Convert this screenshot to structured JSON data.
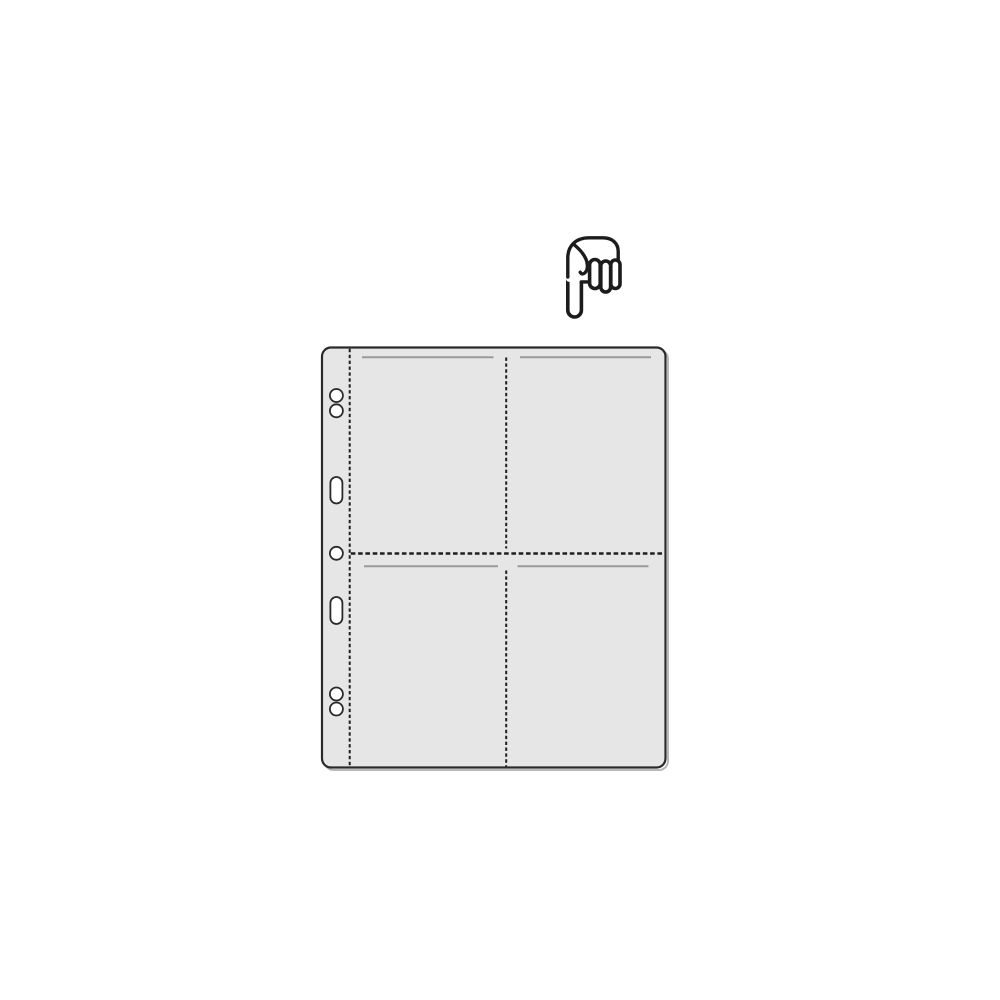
{
  "canvas": {
    "width": 1000,
    "height": 1000,
    "background": "#ffffff"
  },
  "colors": {
    "outline": "#222222",
    "page_fill": "#e6e6e6",
    "page_border": "#2a2a2a",
    "shadow": "#b8b8b8",
    "stitch_line": "#1f1f1f",
    "pocket_opening_line": "#9a9a9a",
    "hole_fill": "#ffffff",
    "hand_stroke": "#1c1c1c",
    "hand_fill": "#ffffff"
  },
  "hand_icon": {
    "name": "pointing-down-hand-icon",
    "gesture": "index-finger-pointing-down"
  },
  "pocket_page": {
    "pockets": 4,
    "columns": 2,
    "rows": 2,
    "round_holes": 5,
    "slot_holes": 2
  }
}
